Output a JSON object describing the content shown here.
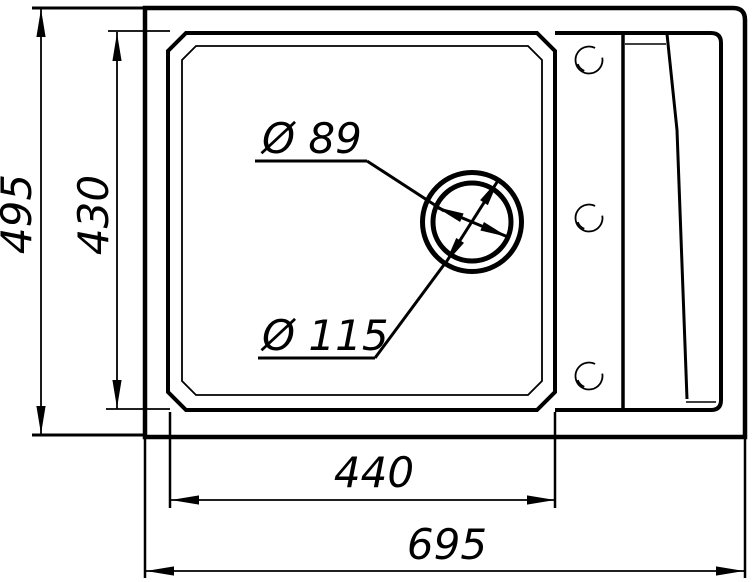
{
  "drawing": {
    "dim_labels": {
      "overall_height": "495",
      "bowl_height": "430",
      "bowl_width": "440",
      "overall_width": "695",
      "drain_small_diameter": "Ø 89",
      "drain_large_diameter": "Ø 115"
    },
    "colors": {
      "line": "#000000",
      "background": "#ffffff"
    }
  }
}
